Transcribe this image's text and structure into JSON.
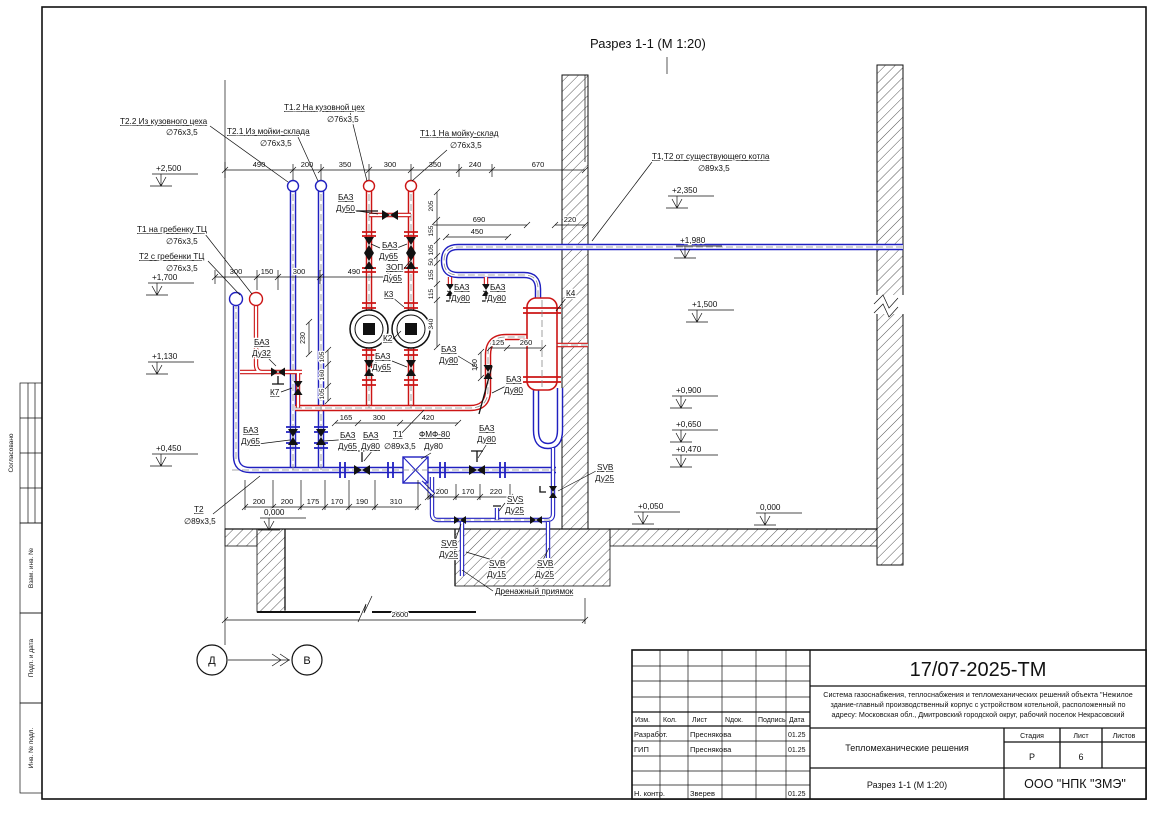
{
  "page": {
    "section_title": "Разрез 1-1 (М 1:20)"
  },
  "frame_stamps": {
    "soglasovano": "Согласовано",
    "vzam": "Взам. инв. №",
    "podp": "Подп. и дата",
    "inv": "Инв. № подл."
  },
  "axes": {
    "left": "Д",
    "right": "В"
  },
  "leaders": {
    "t22_line1": "Т2.2 Из кузовного цеха",
    "t22_line2": "∅76х3,5",
    "t21_line1": "Т2.1 Из мойки-склада",
    "t21_line2": "∅76х3,5",
    "t12_line1": "Т1.2 На кузовной цех",
    "t12_line2": "∅76х3,5",
    "t11_line1": "Т1.1 На мойку-склад",
    "t11_line2": "∅76х3,5",
    "boiler_line1": "Т1,Т2 от существующего котла",
    "boiler_line2": "∅89х3,5",
    "t1_comb_line1": "Т1 на гребенку ТЦ",
    "t1_comb_line2": "∅76х3,5",
    "t2_comb_line1": "Т2 с гребенки ТЦ",
    "t2_comb_line2": "∅76х3,5",
    "t2_line1": "Т2",
    "t2_line2": "∅89х3,5",
    "t1_line1": "Т1",
    "t1_line2": "∅89х3,5",
    "fmf_line1": "ФМФ-80",
    "fmf_line2": "Ду80",
    "pit": "Дренажный приямок"
  },
  "equipment": {
    "baz": "БАЗ",
    "zop": "ЗОП",
    "du50": "Ду50",
    "du65": "Ду65",
    "du80": "Ду80",
    "du32": "Ду32",
    "du25": "Ду25",
    "du15": "Ду15",
    "svb": "SVB",
    "svs": "SVS",
    "k2": "К2",
    "k3": "К3",
    "k4": "К4",
    "k7": "К7"
  },
  "elevations": {
    "left": [
      "+2,500",
      "+1,700",
      "+1,130",
      "+0,450"
    ],
    "right": [
      "+2,350",
      "+1,980",
      "+1,500",
      "+0,900",
      "+0,650",
      "+0,470",
      "+0,050",
      "0,000"
    ],
    "floor_left": "0,000"
  },
  "dims": {
    "top": [
      "490",
      "200",
      "350",
      "300",
      "350",
      "240",
      "670"
    ],
    "upper_left": [
      "300",
      "150",
      "300",
      "490"
    ],
    "d690": "690",
    "d450": "450",
    "d220": "220",
    "d125": "125",
    "d260": "260",
    "d190": "190",
    "d230": "230",
    "mid": [
      "165",
      "300",
      "420"
    ],
    "v1": [
      "205",
      "155",
      "105",
      "50",
      "155",
      "115",
      "340"
    ],
    "v2": [
      "105",
      "160",
      "105"
    ],
    "bottom1": [
      "200",
      "200",
      "175",
      "170",
      "190",
      "310"
    ],
    "bottom2": [
      "200",
      "170",
      "220"
    ],
    "total": "2600"
  },
  "titleblock": {
    "doc_number": "17/07-2025-ТМ",
    "description_line1": "Система газоснабжения, теплоснабжения и тепломеханических решений объекта \"Нежилое",
    "description_line2": "здание-главный производственный корпус с устройством котельной, расположенный по",
    "description_line3": "адресу: Московская обл., Дмитровский городской округ, рабочий поселок Некрасовский",
    "section_name": "Тепломеханические решения",
    "view_name": "Разрез 1-1 (М 1:20)",
    "company": "ООО \"НПК \"ЗМЭ\"",
    "col_izm": "Изм.",
    "col_kol": "Кол.",
    "col_list": "Лист",
    "col_ndok": "Nдок.",
    "col_podpis": "Подпись",
    "col_data": "Дата",
    "stage_label": "Стадия",
    "sheet_label": "Лист",
    "sheets_label": "Листов",
    "stage_value": "Р",
    "sheet_value": "6",
    "row1_role": "Разработ.",
    "row1_name": "Преснякова",
    "row1_date": "01.25",
    "row2_role": "ГИП",
    "row2_name": "Преснякова",
    "row2_date": "01.25",
    "row3_role": "Н. контр.",
    "row3_name": "Зверев",
    "row3_date": "01.25"
  }
}
